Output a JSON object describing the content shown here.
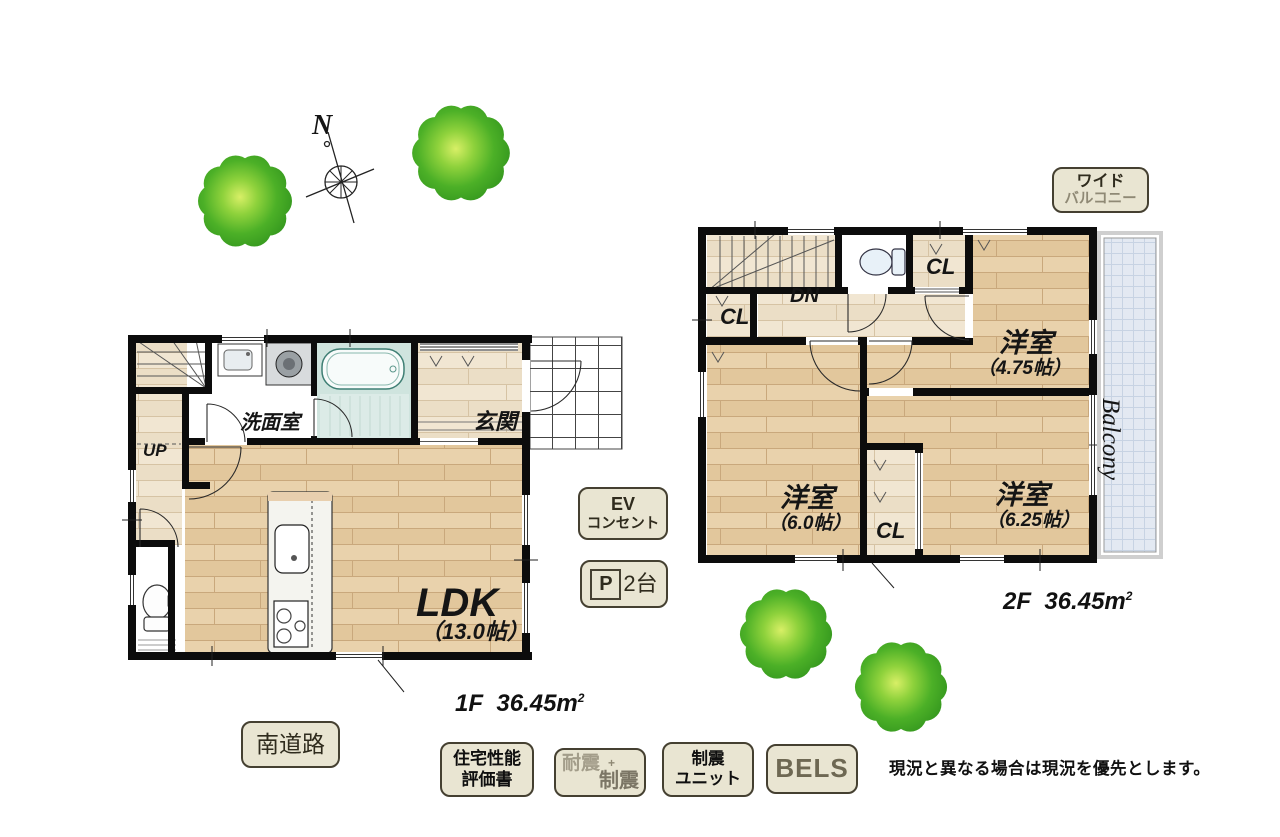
{
  "colors": {
    "wall": "#0c0c0c",
    "wood_floor": "#e7cfa8",
    "wood_light": "#f0e5d1",
    "bath_teal": "#cfe4de",
    "balcony_fill": "#e3e9f2",
    "badge_bg": "#e9e5d2",
    "badge_border": "#454031",
    "tree_green": "#4cb027"
  },
  "compass": {
    "north": "N"
  },
  "floor1": {
    "stairs": "UP",
    "washroom": "洗面室",
    "entrance": "玄関",
    "ldk": "LDK",
    "ldk_size": "（13.0帖）",
    "area_floor": "1F",
    "area_value": "36.45m",
    "area_sup": "2"
  },
  "floor2": {
    "stairs": "DN",
    "cl_left": "CL",
    "cl_top": "CL",
    "cl_bottom": "CL",
    "room475": "洋室",
    "room475_size": "（4.75帖）",
    "room60": "洋室",
    "room60_size": "（6.0帖）",
    "room625": "洋室",
    "room625_size": "（6.25帖）",
    "balcony": "Balcony",
    "area_floor": "2F",
    "area_value": "36.45m",
    "area_sup": "2"
  },
  "badges": {
    "wide_balcony": {
      "line1": "ワイド",
      "line2": "バルコニー"
    },
    "ev_outlet": {
      "line1": "EV",
      "line2": "コンセント"
    },
    "parking": {
      "symbol": "P",
      "count": "2台"
    },
    "south_road": "南道路",
    "housing_performance": {
      "line1": "住宅性能",
      "line2": "評価書"
    },
    "earthquake": {
      "line1": "耐震",
      "plus": "+",
      "line2": "制震"
    },
    "damper_unit": {
      "line1": "制震",
      "line2": "ユニット"
    },
    "bels": "BELS"
  },
  "notes": {
    "disclaimer": "現況と異なる場合は現況を優先とします。"
  }
}
